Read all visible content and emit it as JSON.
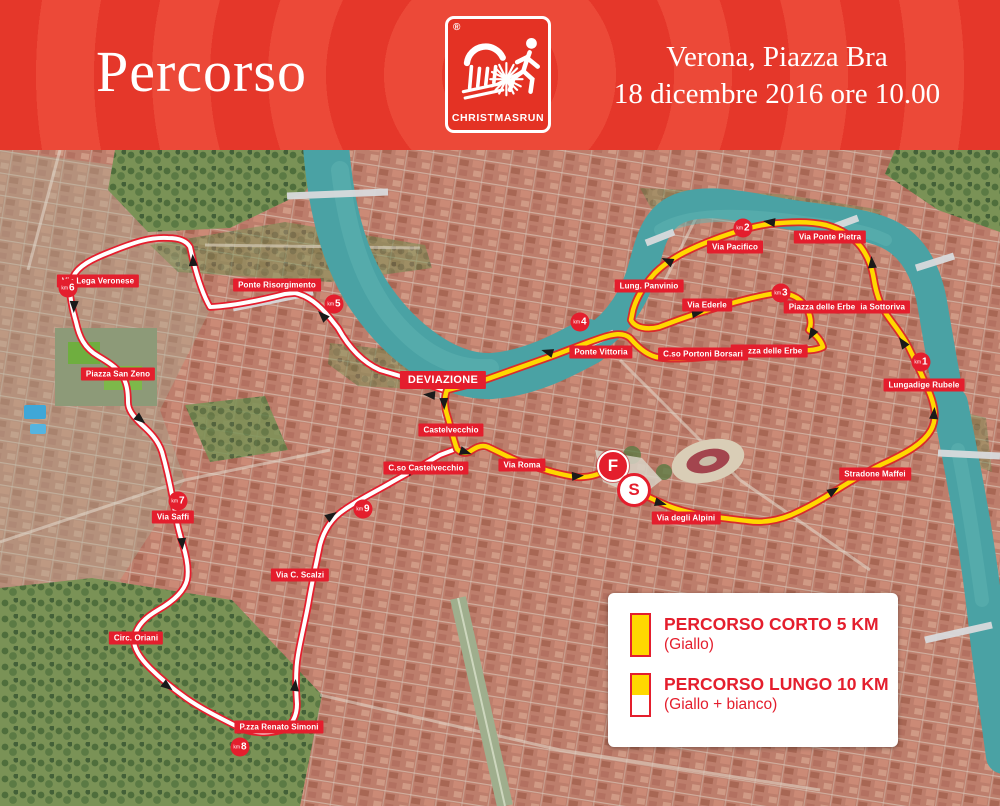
{
  "header": {
    "title": "Percorso",
    "event_location": "Verona, Piazza Bra",
    "event_datetime": "18 dicembre 2016 ore 10.00",
    "logo": {
      "brand": "CHRISTMASRUN",
      "registered_mark": "®"
    }
  },
  "legend": {
    "items": [
      {
        "title": "PERCORSO CORTO 5 KM",
        "subtitle": "(Giallo)",
        "swatch": "yellow"
      },
      {
        "title": "PERCORSO LUNGO 10 KM",
        "subtitle": "(Giallo + bianco)",
        "swatch": "split"
      }
    ]
  },
  "map": {
    "street_labels": [
      {
        "text": "Via Lega Veronese",
        "x": 98,
        "y": 131
      },
      {
        "text": "Ponte Risorgimento",
        "x": 277,
        "y": 135
      },
      {
        "text": "Piazza San Zeno",
        "x": 118,
        "y": 224
      },
      {
        "text": "Via Saffi",
        "x": 173,
        "y": 367
      },
      {
        "text": "Circ. Oriani",
        "x": 136,
        "y": 488
      },
      {
        "text": "P.zza Renato Simoni",
        "x": 279,
        "y": 577
      },
      {
        "text": "Via C. Scalzi",
        "x": 300,
        "y": 425
      },
      {
        "text": "C.so Castelvecchio",
        "x": 426,
        "y": 318
      },
      {
        "text": "Castelvecchio",
        "x": 451,
        "y": 280
      },
      {
        "text": "DEVIAZIONE",
        "x": 443,
        "y": 230,
        "variant": "big"
      },
      {
        "text": "Via Roma",
        "x": 522,
        "y": 315
      },
      {
        "text": "Via degli Alpini",
        "x": 686,
        "y": 368
      },
      {
        "text": "Stradone Maffei",
        "x": 875,
        "y": 324
      },
      {
        "text": "Lungadige Rubele",
        "x": 924,
        "y": 235
      },
      {
        "text": "Via Sottoriva",
        "x": 880,
        "y": 157
      },
      {
        "text": "Via Ponte Pietra",
        "x": 830,
        "y": 87
      },
      {
        "text": "Via Pacifico",
        "x": 735,
        "y": 97
      },
      {
        "text": "Lung. Panvinio",
        "x": 649,
        "y": 136
      },
      {
        "text": "Via Ederle",
        "x": 707,
        "y": 155
      },
      {
        "text": "Piazza delle Erbe",
        "x": 822,
        "y": 157
      },
      {
        "text": "Piazza delle Erbe",
        "x": 769,
        "y": 201
      },
      {
        "text": "C.so Portoni Borsari",
        "x": 703,
        "y": 204
      },
      {
        "text": "Ponte Vittoria",
        "x": 601,
        "y": 202
      }
    ],
    "km_unit": "km",
    "km_markers": [
      {
        "num": "1",
        "x": 921,
        "y": 212
      },
      {
        "num": "2",
        "x": 743,
        "y": 78
      },
      {
        "num": "3",
        "x": 781,
        "y": 143
      },
      {
        "num": "4",
        "x": 580,
        "y": 172
      },
      {
        "num": "5",
        "x": 334,
        "y": 154
      },
      {
        "num": "6",
        "x": 68,
        "y": 138
      },
      {
        "num": "7",
        "x": 178,
        "y": 351
      },
      {
        "num": "8",
        "x": 240,
        "y": 597
      },
      {
        "num": "9",
        "x": 363,
        "y": 359
      }
    ],
    "start_marker": {
      "label": "S",
      "x": 634,
      "y": 340
    },
    "finish_marker": {
      "label": "F",
      "x": 613,
      "y": 316
    }
  },
  "colors": {
    "accent_red": "#e41e2d",
    "route_yellow": "#ffd800",
    "route_white": "#ffffff",
    "river_teal": "#4aa2a4"
  }
}
